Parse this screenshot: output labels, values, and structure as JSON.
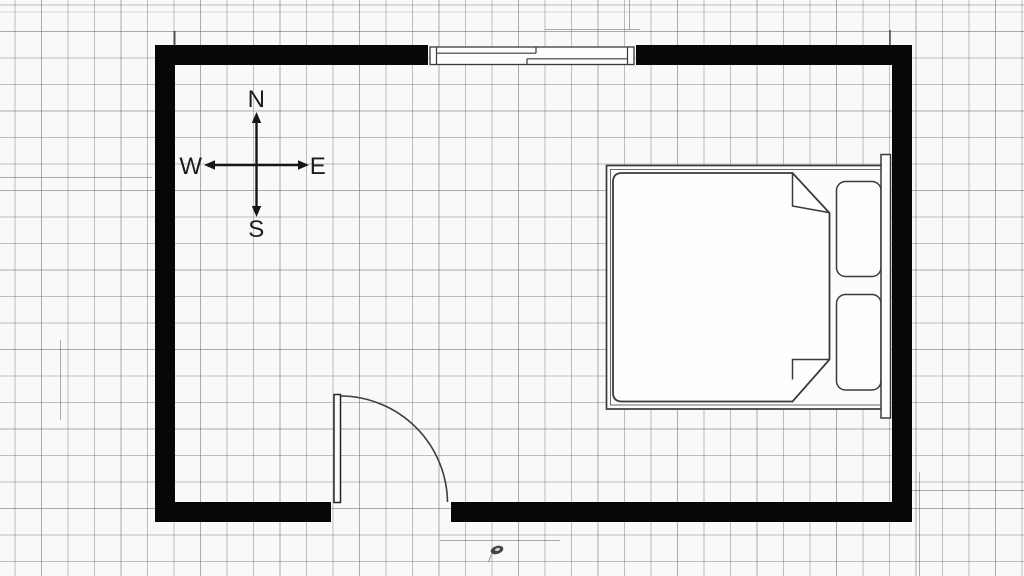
{
  "compass": {
    "north": "N",
    "south": "S",
    "east": "E",
    "west": "W"
  },
  "colors": {
    "wall": "#070707",
    "furniture_line": "#3a3a3a",
    "paper": "#f9f9f9",
    "grid_line": "#a6a6a6",
    "object_fill": "#fdfdfd"
  },
  "plan": {
    "room": "bedroom",
    "walls": [
      "north",
      "east",
      "south",
      "west"
    ],
    "openings": [
      {
        "type": "sliding-window",
        "wall": "north"
      },
      {
        "type": "hinged-door",
        "wall": "south",
        "swing": "opens-inward-left-hinge"
      }
    ],
    "furniture": [
      {
        "type": "double-bed",
        "against_wall": "east",
        "parts": [
          "bed-frame",
          "blanket",
          "folded-corner-top",
          "folded-corner-bottom",
          "pillow-upper",
          "pillow-lower",
          "headboard"
        ]
      }
    ],
    "annotations": [
      "compass-rose",
      "pencil-tick-left",
      "pencil-tick-right",
      "ink-smudge"
    ]
  }
}
